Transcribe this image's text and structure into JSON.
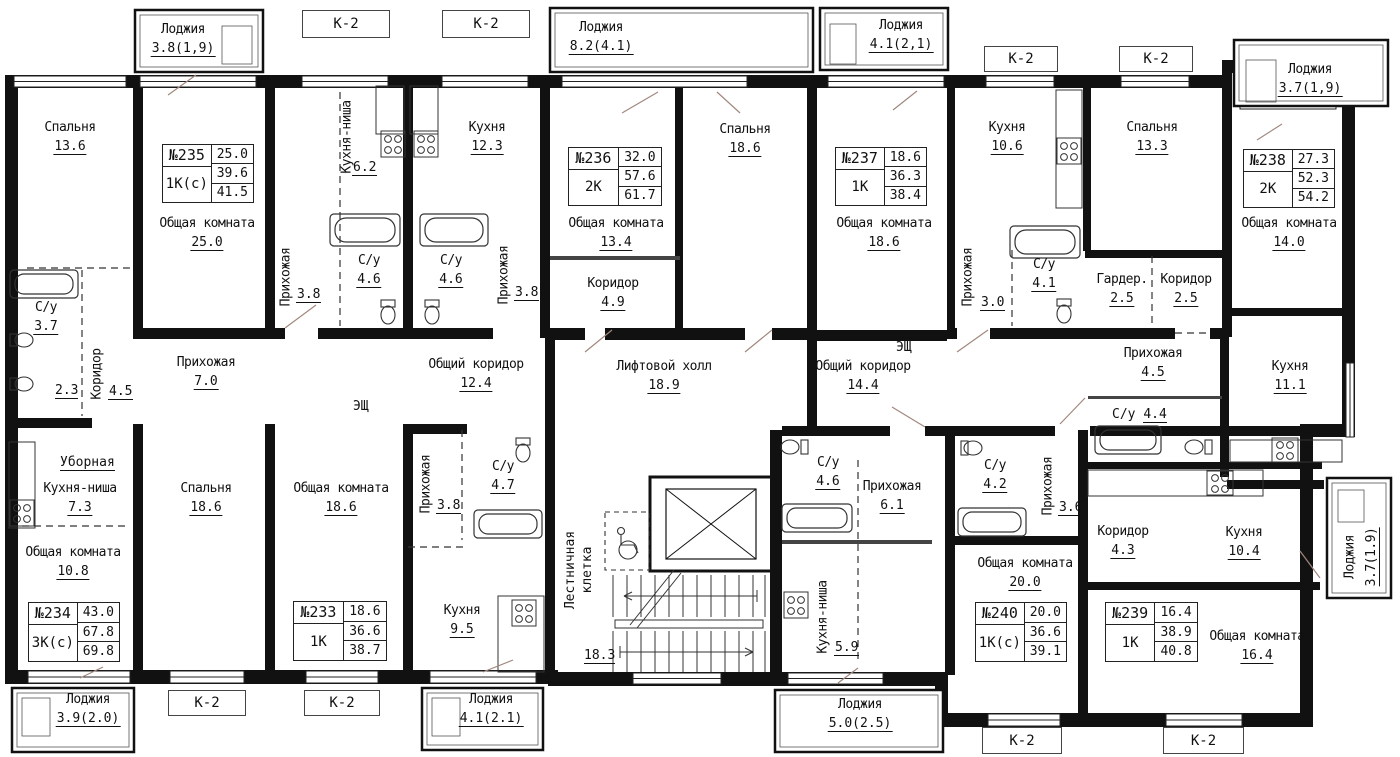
{
  "apartments": [
    {
      "number": "№235",
      "type": "1К(с)",
      "values": [
        "25.0",
        "39.6",
        "41.5"
      ]
    },
    {
      "number": "№236",
      "type": "2К",
      "values": [
        "32.0",
        "57.6",
        "61.7"
      ]
    },
    {
      "number": "№237",
      "type": "1К",
      "values": [
        "18.6",
        "36.3",
        "38.4"
      ]
    },
    {
      "number": "№238",
      "type": "2К",
      "values": [
        "27.3",
        "52.3",
        "54.2"
      ]
    },
    {
      "number": "№234",
      "type": "3К(с)",
      "values": [
        "43.0",
        "67.8",
        "69.8"
      ]
    },
    {
      "number": "№233",
      "type": "1К",
      "values": [
        "18.6",
        "36.6",
        "38.7"
      ]
    },
    {
      "number": "№240",
      "type": "1К(с)",
      "values": [
        "20.0",
        "36.6",
        "39.1"
      ]
    },
    {
      "number": "№239",
      "type": "1К",
      "values": [
        "16.4",
        "38.9",
        "40.8"
      ]
    }
  ],
  "rooms": [
    {
      "name": "Спальня",
      "area": "13.6"
    },
    {
      "name": "Общая комната",
      "area": "25.0"
    },
    {
      "name": "Кухня",
      "area": "12.3"
    },
    {
      "name": "Спальня",
      "area": "18.6"
    },
    {
      "name": "Общая комната",
      "area": "13.4"
    },
    {
      "name": "Коридор",
      "area": "4.9"
    },
    {
      "name": "Общая комната",
      "area": "18.6"
    },
    {
      "name": "Кухня",
      "area": "10.6"
    },
    {
      "name": "Спальня",
      "area": "13.3"
    },
    {
      "name": "Общая комната",
      "area": "14.0"
    },
    {
      "name": "С/у",
      "area": "3.7"
    },
    {
      "name": "Прихожая",
      "area": "7.0"
    },
    {
      "name": "С/у",
      "area": "4.6"
    },
    {
      "name": "С/у",
      "area": "4.6"
    },
    {
      "name": "Общий коридор",
      "area": "12.4"
    },
    {
      "name": "Лифтовой холл",
      "area": "18.9"
    },
    {
      "name": "Общий коридор",
      "area": "14.4"
    },
    {
      "name": "С/у",
      "area": "4.1"
    },
    {
      "name": "Гардер.",
      "area": "2.5"
    },
    {
      "name": "Коридор",
      "area": "2.5"
    },
    {
      "name": "Прихожая",
      "area": "4.5"
    },
    {
      "name": "Кухня",
      "area": "11.1"
    },
    {
      "name": "Кухня-ниша",
      "area": "7.3"
    },
    {
      "name": "Общая комната",
      "area": "10.8"
    },
    {
      "name": "Спальня",
      "area": "18.6"
    },
    {
      "name": "Общая комната",
      "area": "18.6"
    },
    {
      "name": "С/у",
      "area": "4.7"
    },
    {
      "name": "Кухня",
      "area": "9.5"
    },
    {
      "name": "С/у",
      "area": "4.6"
    },
    {
      "name": "Прихожая",
      "area": "6.1"
    },
    {
      "name": "С/у",
      "area": "4.2"
    },
    {
      "name": "Общая комната",
      "area": "20.0"
    },
    {
      "name": "Коридор",
      "area": "4.3"
    },
    {
      "name": "Кухня",
      "area": "10.4"
    },
    {
      "name": "Общая комната",
      "area": "16.4"
    }
  ],
  "vrooms": [
    {
      "name": "Кухня-ниша",
      "area": "6.2"
    },
    {
      "name": "Коридор",
      "area": "4.5"
    },
    {
      "name": "Прихожая",
      "area": "3.8"
    },
    {
      "name": "Прихожая",
      "area": "3.8"
    },
    {
      "name": "Прихожая",
      "area": "3.0"
    },
    {
      "name": "Прихожая",
      "area": "3.8"
    },
    {
      "name": "Прихожая",
      "area": "3.6"
    },
    {
      "name": "Кухня-ниша",
      "area": "5.9"
    }
  ],
  "stair": {
    "line1": "Лестничная",
    "line2": "клетка",
    "area": "18.3"
  },
  "loggias": [
    {
      "name": "Лоджия",
      "area": "3.8(1,9)"
    },
    {
      "name": "Лоджия",
      "area": "8.2(4.1)"
    },
    {
      "name": "Лоджия",
      "area": "4.1(2,1)"
    },
    {
      "name": "Лоджия",
      "area": "3.7(1,9)"
    },
    {
      "name": "Лоджия",
      "area": "3.9(2.0)"
    },
    {
      "name": "Лоджия",
      "area": "4.1(2.1)"
    },
    {
      "name": "Лоджия",
      "area": "5.0(2.5)"
    }
  ],
  "vloggia": {
    "name": "Лоджия",
    "area": "3.7(1.9)"
  },
  "misc": {
    "k2": "К-2",
    "esh": "ЭЩ",
    "ubornaya": "Уборная",
    "toilet_area": "2.3",
    "su_name": "С/у",
    "su_area": "4.4",
    "stair_area": "18.3",
    "wall_color": "#111111",
    "door_color": "#a1887f"
  }
}
